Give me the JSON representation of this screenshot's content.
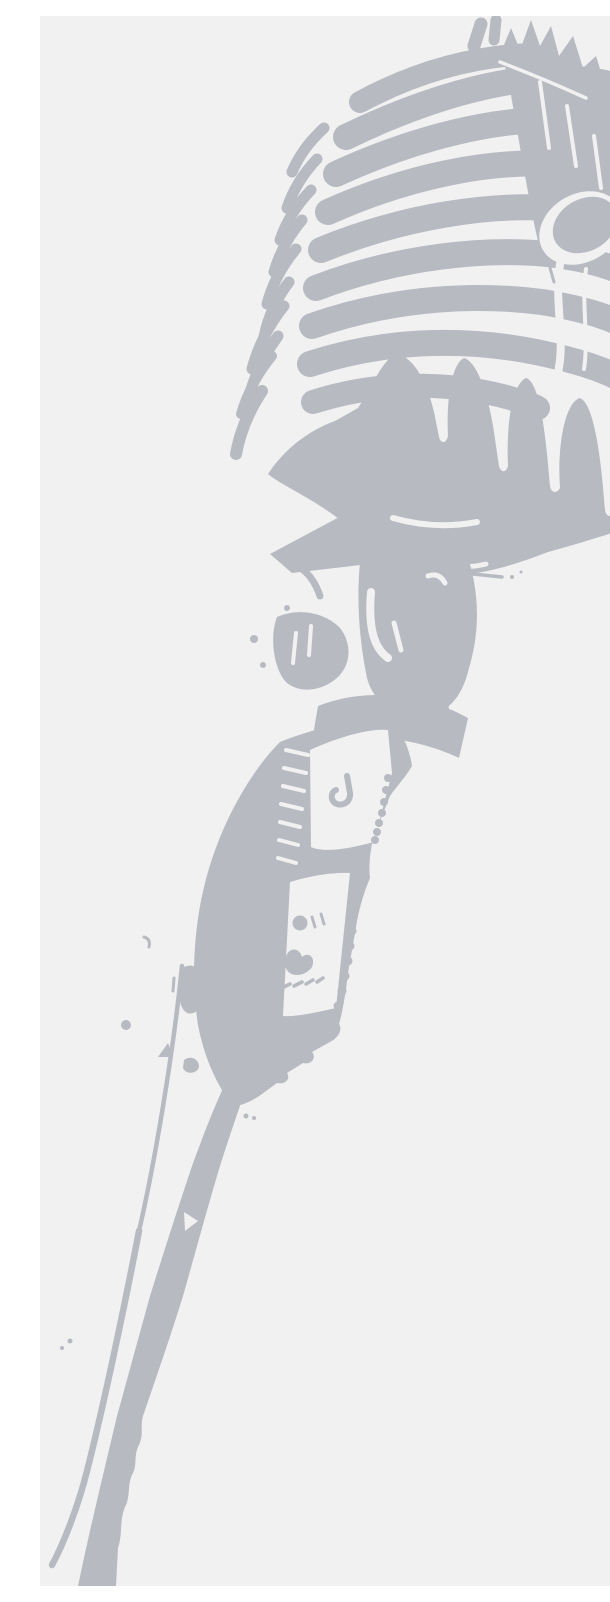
{
  "image": {
    "alt": "Light grey stencil silhouette of a vintage ribbed microphone, head tilted to the upper right, mounted on a long stand that leans toward the lower left corner",
    "subject": "vintage microphone on stand",
    "style": "posterized two-tone stencil print",
    "text_content": "none"
  },
  "colors": {
    "background": "#f1f1f2",
    "microphone": "#b7bac1"
  },
  "canvas": {
    "width": "610",
    "height": "1570"
  }
}
